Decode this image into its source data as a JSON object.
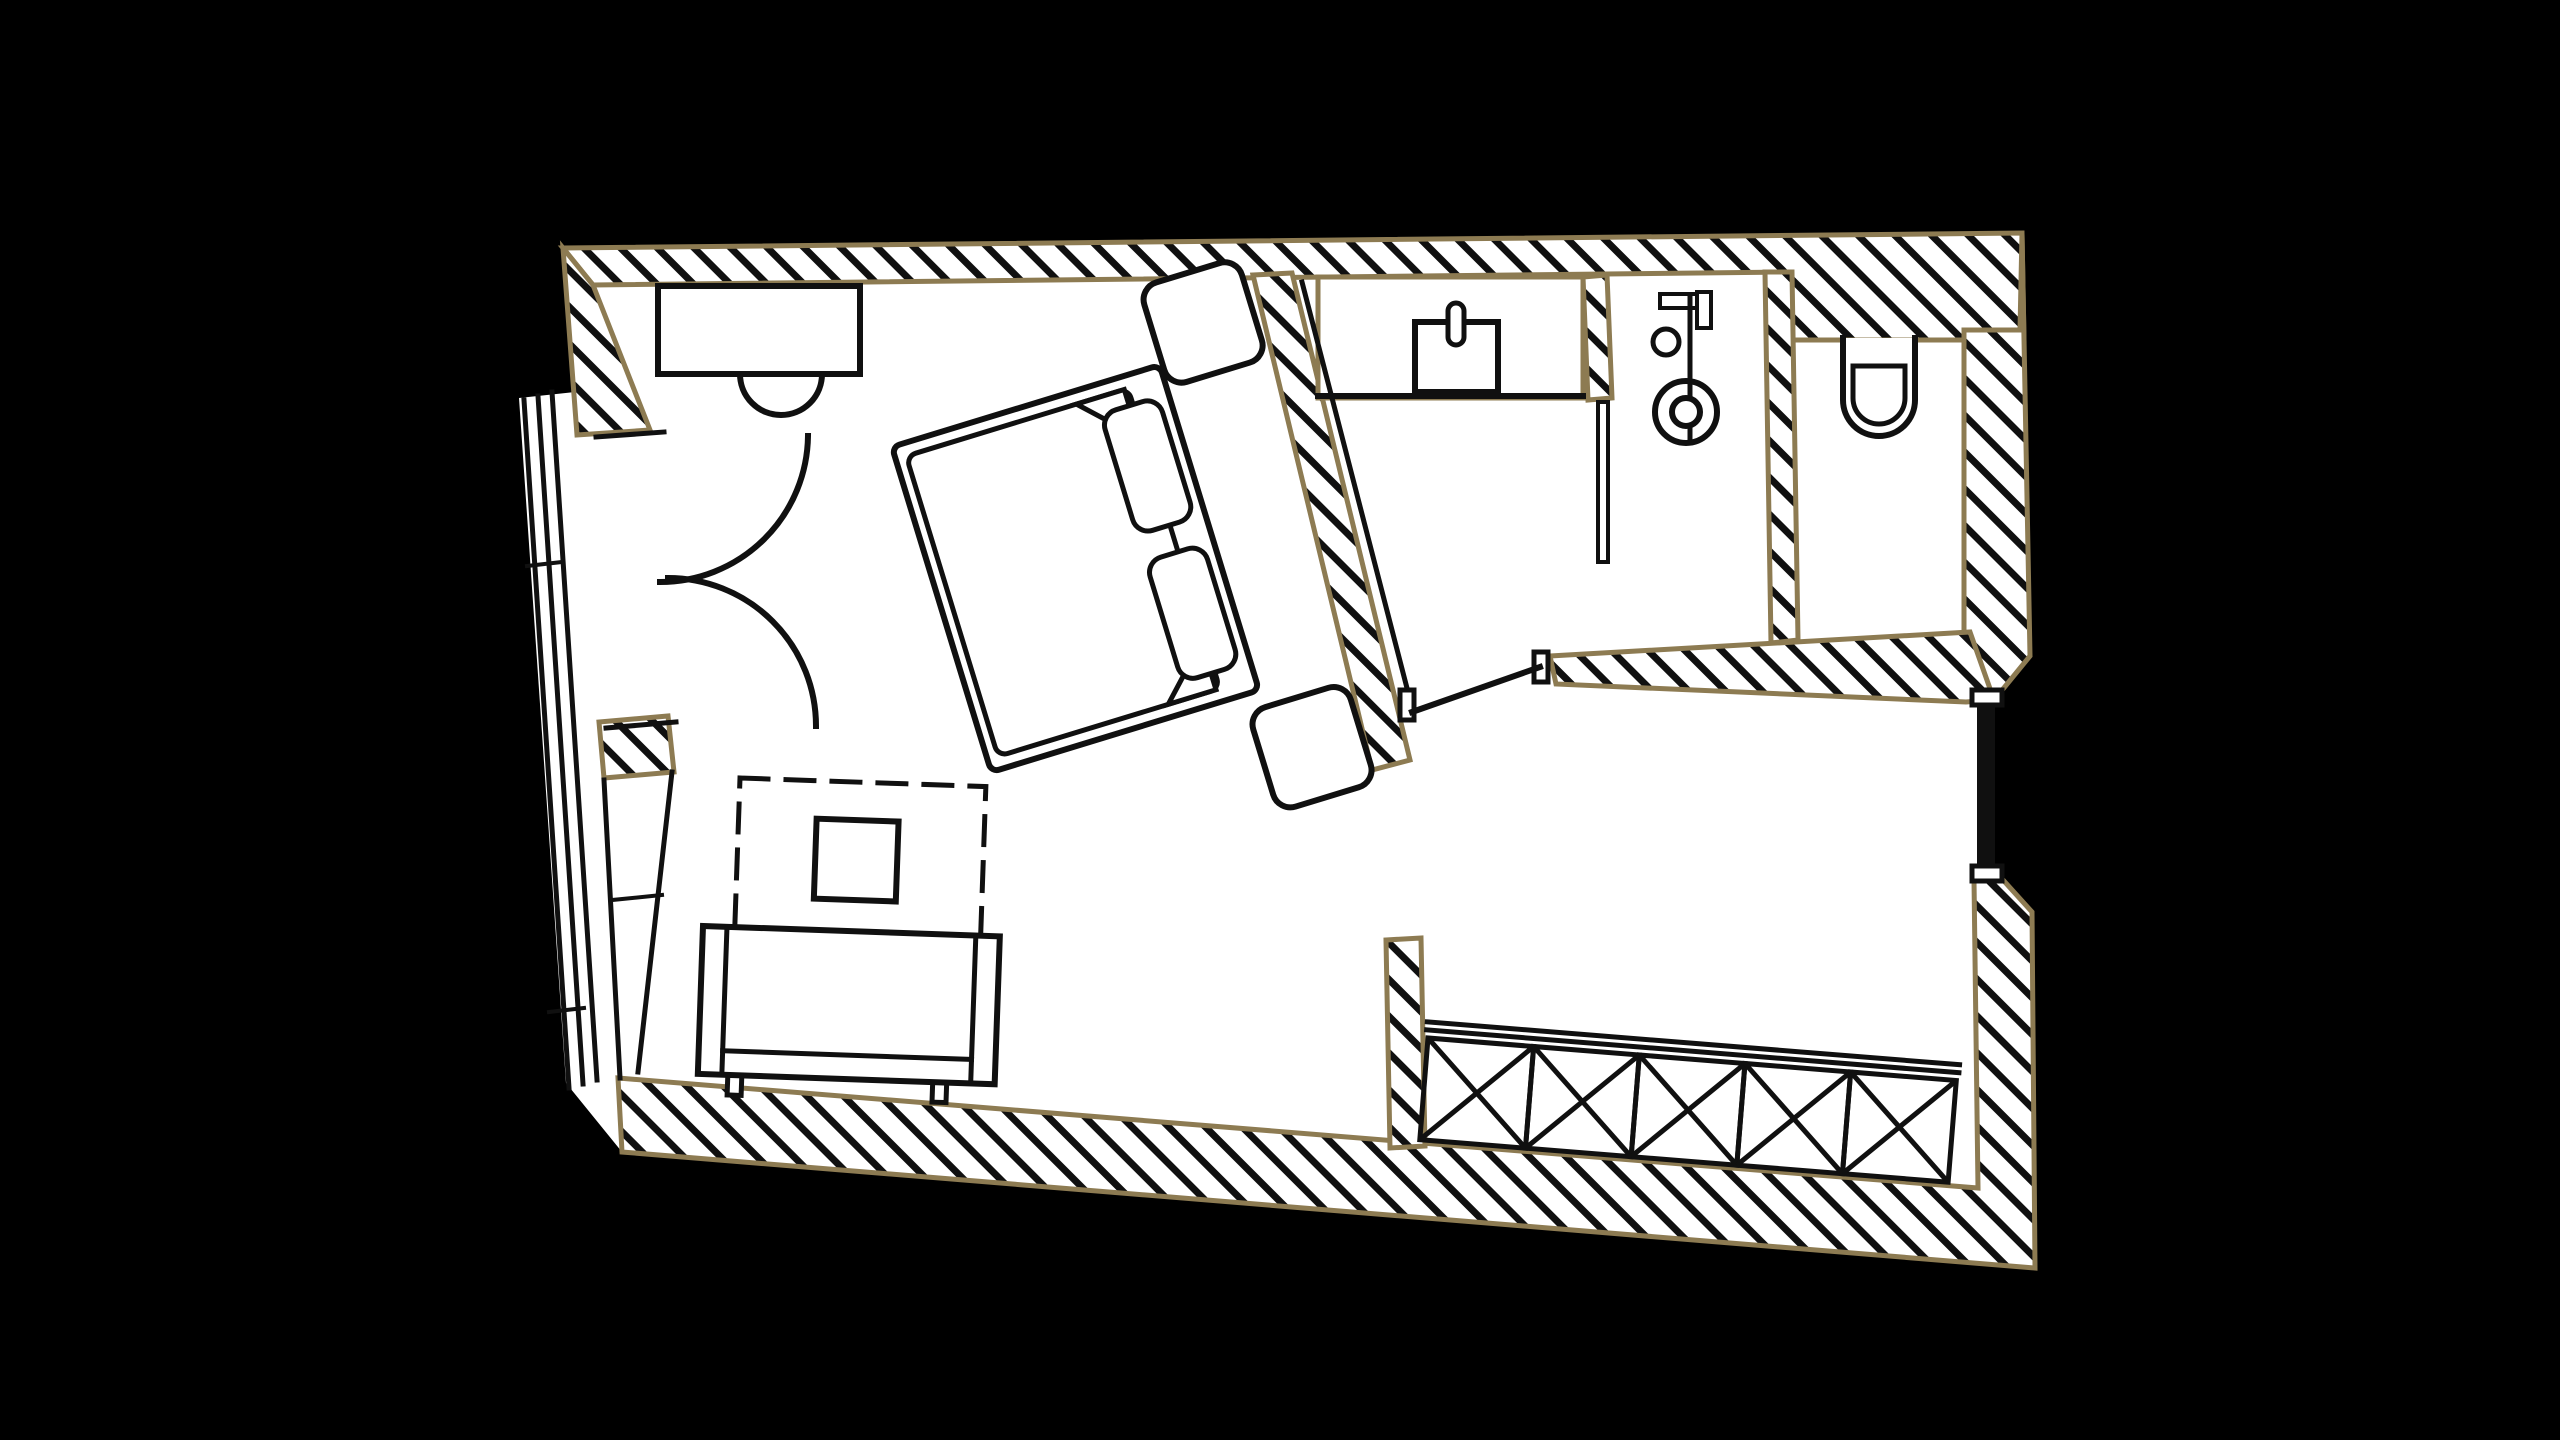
{
  "canvas": {
    "width": 2560,
    "height": 1440,
    "background": "#000000"
  },
  "palette": {
    "background": "#000000",
    "floor": "#ffffff",
    "ink": "#101010",
    "wall_outline": "#8d7b52",
    "hatch_spacing": 26,
    "hatch_line_width": 7,
    "hatch_angle": -45
  },
  "shapes": [
    {
      "name": "floor-area",
      "kind": "polygon",
      "points": "563,248 2022,233 2030,656 1994,700 1994,870 2032,912 2035,1268 622,1152 566,1083 519,398 575,392",
      "fill": "white",
      "stroke": "none"
    },
    {
      "name": "wall-top",
      "kind": "polygon",
      "points": "563,248 2022,233 2024,340 1787,340 1785,272 593,285",
      "fill": "hatch",
      "stroke": "tan",
      "sw": 5
    },
    {
      "name": "wall-right-upper",
      "kind": "polygon",
      "points": "2022,233 2030,656 1994,700 1964,700 1964,330 2020,330",
      "fill": "hatch",
      "stroke": "tan",
      "sw": 5
    },
    {
      "name": "wall-bottom-right",
      "kind": "polygon",
      "points": "618,1078 1978,1188 1974,880 1994,870 2032,912 2035,1268 622,1152",
      "fill": "hatch",
      "stroke": "tan",
      "sw": 5
    },
    {
      "name": "wall-left-upper",
      "kind": "polygon",
      "points": "563,248 577,435 650,430 593,285",
      "fill": "hatch",
      "stroke": "tan",
      "sw": 5
    },
    {
      "name": "wall-left-stub",
      "kind": "polygon",
      "points": "599,722 604,778 674,772 668,716",
      "fill": "hatch",
      "stroke": "tan",
      "sw": 5
    },
    {
      "name": "wall-bed-bathroom",
      "kind": "polygon",
      "points": "1253,275 1292,273 1410,760 1372,770",
      "fill": "hatch",
      "stroke": "tan",
      "sw": 5
    },
    {
      "name": "wall-shower-wc-divider",
      "kind": "polygon",
      "points": "1765,272 1792,272 1798,640 1771,643",
      "fill": "hatch",
      "stroke": "tan",
      "sw": 5
    },
    {
      "name": "wall-bathroom-low",
      "kind": "polygon",
      "points": "1550,656 1970,632 1994,700 1966,702 1556,684",
      "fill": "hatch",
      "stroke": "tan",
      "sw": 5
    },
    {
      "name": "wall-vanity-stub",
      "kind": "polygon",
      "points": "1583,277 1607,275 1612,398 1588,400",
      "fill": "hatch",
      "stroke": "tan",
      "sw": 5
    },
    {
      "name": "wall-wardrobe-stub",
      "kind": "polygon",
      "points": "1386,940 1421,938 1425,1146 1390,1148",
      "fill": "hatch",
      "stroke": "tan",
      "sw": 5
    },
    {
      "name": "balcony-railing",
      "kind": "group",
      "children": [
        {
          "name": "railing-line-outer",
          "kind": "line",
          "x1": 524,
          "y1": 400,
          "x2": 569,
          "y2": 1088,
          "sw": 5
        },
        {
          "name": "railing-line-middle",
          "kind": "line",
          "x1": 538,
          "y1": 396,
          "x2": 583,
          "y2": 1084,
          "sw": 5
        },
        {
          "name": "railing-line-inner",
          "kind": "line",
          "x1": 552,
          "y1": 392,
          "x2": 597,
          "y2": 1080,
          "sw": 5
        },
        {
          "name": "railing-tick-upper",
          "kind": "line",
          "x1": 527,
          "y1": 566,
          "x2": 562,
          "y2": 562,
          "sw": 4
        },
        {
          "name": "railing-tick-lower",
          "kind": "line",
          "x1": 549,
          "y1": 1012,
          "x2": 584,
          "y2": 1008,
          "sw": 4
        }
      ]
    },
    {
      "name": "left-window",
      "kind": "group",
      "children": [
        {
          "name": "window-outer-line",
          "kind": "line",
          "x1": 604,
          "y1": 780,
          "x2": 620,
          "y2": 1078,
          "sw": 5
        },
        {
          "name": "window-inner-line",
          "kind": "line",
          "x1": 672,
          "y1": 772,
          "x2": 638,
          "y2": 1072,
          "sw": 5
        },
        {
          "name": "window-crossbar",
          "kind": "line",
          "x1": 612,
          "y1": 900,
          "x2": 662,
          "y2": 895,
          "sw": 4
        }
      ]
    },
    {
      "name": "entry-double-door",
      "kind": "group",
      "children": [
        {
          "name": "door-jamb-top",
          "kind": "line",
          "x1": 596,
          "y1": 437,
          "x2": 664,
          "y2": 432,
          "sw": 5
        },
        {
          "name": "door-jamb-bottom",
          "kind": "line",
          "x1": 606,
          "y1": 728,
          "x2": 676,
          "y2": 722,
          "sw": 5
        },
        {
          "name": "door-leaf-upper-arc",
          "kind": "path",
          "d": "M 808 436 A 148 148 0 0 1 660 582",
          "sw": 6
        },
        {
          "name": "door-leaf-lower-arc",
          "kind": "path",
          "d": "M 668 578 A 148 148 0 0 1 816 726",
          "sw": 6
        }
      ]
    },
    {
      "name": "desk",
      "kind": "rect",
      "x": 658,
      "y": 286,
      "w": 202,
      "h": 88,
      "sw": 6,
      "fill": "white"
    },
    {
      "name": "desk-chair",
      "kind": "path",
      "d": "M 740 374 A 41 41 0 0 0 822 374",
      "sw": 6,
      "fill": "none"
    },
    {
      "name": "bed",
      "kind": "group",
      "transform": "translate(1195,532) rotate(73)",
      "children": [
        {
          "name": "nightstand-upper",
          "kind": "rect",
          "x": -250,
          "y": -120,
          "w": 104,
          "h": 102,
          "rx": 18,
          "sw": 6,
          "fill": "white"
        },
        {
          "name": "nightstand-lower",
          "kind": "rect",
          "x": 188,
          "y": -100,
          "w": 104,
          "h": 102,
          "rx": 18,
          "sw": 6,
          "fill": "white"
        },
        {
          "name": "bed-frame",
          "kind": "rect",
          "x": -170,
          "y": -15,
          "w": 340,
          "h": 280,
          "rx": 8,
          "sw": 6,
          "fill": "white"
        },
        {
          "name": "mattress",
          "kind": "rect",
          "x": -157,
          "y": 22,
          "w": 314,
          "h": 232,
          "rx": 10,
          "sw": 5,
          "fill": "none"
        },
        {
          "name": "blanket-fold-left",
          "kind": "path",
          "d": "M -157 26 L -107 26 L -157 76 Z",
          "sw": 5,
          "fill": "white"
        },
        {
          "name": "blanket-fold-right",
          "kind": "path",
          "d": "M 157 26 L 107 26 L 157 76 Z",
          "sw": 5,
          "fill": "white"
        },
        {
          "name": "pillow-left",
          "kind": "rect",
          "x": -140,
          "y": -4,
          "w": 126,
          "h": 60,
          "rx": 16,
          "sw": 5,
          "fill": "white"
        },
        {
          "name": "pillow-right",
          "kind": "rect",
          "x": 14,
          "y": -4,
          "w": 126,
          "h": 60,
          "rx": 16,
          "sw": 5,
          "fill": "white"
        }
      ]
    },
    {
      "name": "vanity-counter",
      "kind": "rect",
      "x": 1318,
      "y": 277,
      "w": 265,
      "h": 121,
      "sw": 5,
      "stroke": "tan",
      "fill": "white"
    },
    {
      "name": "vanity-front-edge",
      "kind": "line",
      "x1": 1318,
      "y1": 396,
      "x2": 1583,
      "y2": 396,
      "sw": 6
    },
    {
      "name": "sink",
      "kind": "rect",
      "x": 1415,
      "y": 322,
      "w": 83,
      "h": 70,
      "sw": 6,
      "fill": "white"
    },
    {
      "name": "faucet",
      "kind": "rect",
      "x": 1448,
      "y": 303,
      "w": 16,
      "h": 42,
      "rx": 8,
      "sw": 5,
      "fill": "white"
    },
    {
      "name": "shower-glass-panel",
      "kind": "rect",
      "x": 1598,
      "y": 402,
      "w": 10,
      "h": 160,
      "sw": 4,
      "fill": "white"
    },
    {
      "name": "shower-arm",
      "kind": "rect",
      "x": 1660,
      "y": 294,
      "w": 38,
      "h": 14,
      "sw": 4,
      "fill": "white"
    },
    {
      "name": "shower-head",
      "kind": "rect",
      "x": 1697,
      "y": 292,
      "w": 14,
      "h": 36,
      "sw": 4,
      "fill": "white"
    },
    {
      "name": "shower-knob",
      "kind": "circle",
      "cx": 1666,
      "cy": 342,
      "r": 13,
      "sw": 5,
      "fill": "white"
    },
    {
      "name": "shower-riser",
      "kind": "line",
      "x1": 1690,
      "y1": 296,
      "x2": 1690,
      "y2": 440,
      "sw": 5
    },
    {
      "name": "shower-drain-ring",
      "kind": "circle",
      "cx": 1686,
      "cy": 412,
      "r": 31,
      "sw": 6,
      "fill": "none"
    },
    {
      "name": "shower-drain-center",
      "kind": "circle",
      "cx": 1686,
      "cy": 412,
      "r": 14,
      "sw": 6,
      "fill": "white"
    },
    {
      "name": "bath-partition-line",
      "kind": "line",
      "x1": 1302,
      "y1": 282,
      "x2": 1408,
      "y2": 692,
      "sw": 5
    },
    {
      "name": "bathroom-door",
      "kind": "group",
      "children": [
        {
          "name": "door-jamb-left",
          "kind": "rect",
          "x": 1400,
          "y": 690,
          "w": 14,
          "h": 30,
          "sw": 5,
          "fill": "white"
        },
        {
          "name": "door-jamb-right",
          "kind": "rect",
          "x": 1534,
          "y": 652,
          "w": 14,
          "h": 30,
          "sw": 5,
          "fill": "white"
        },
        {
          "name": "door-leaf",
          "kind": "line",
          "x1": 1412,
          "y1": 712,
          "x2": 1540,
          "y2": 667,
          "sw": 6
        }
      ]
    },
    {
      "name": "toilet",
      "kind": "group",
      "children": [
        {
          "name": "toilet-bowl-outline",
          "kind": "path",
          "d": "M 1843 338 L 1843 400 A 36 36 0 0 0 1915 400 L 1915 338",
          "sw": 6,
          "fill": "white"
        },
        {
          "name": "toilet-seat",
          "kind": "path",
          "d": "M 1853 366 L 1905 366 L 1905 398 A 26 26 0 0 1 1853 398 Z",
          "sw": 5,
          "fill": "white"
        }
      ]
    },
    {
      "name": "right-window",
      "kind": "group",
      "children": [
        {
          "name": "right-window-bar",
          "kind": "rect",
          "x": 1977,
          "y": 705,
          "w": 18,
          "h": 162,
          "fill": "ink",
          "stroke": "none"
        },
        {
          "name": "right-window-cap-top",
          "kind": "rect",
          "x": 1972,
          "y": 690,
          "w": 30,
          "h": 15,
          "sw": 5,
          "fill": "white"
        },
        {
          "name": "right-window-cap-bottom",
          "kind": "rect",
          "x": 1972,
          "y": 866,
          "w": 30,
          "h": 15,
          "sw": 5,
          "fill": "white"
        }
      ]
    },
    {
      "name": "table-area",
      "kind": "group",
      "transform": "translate(740,778) rotate(2)",
      "children": [
        {
          "name": "ceiling-projection-dashed",
          "kind": "rect",
          "x": 0,
          "y": 0,
          "w": 246,
          "h": 172,
          "sw": 5,
          "dash": [
            28,
            18
          ],
          "fill": "none"
        },
        {
          "name": "side-table",
          "kind": "rect",
          "x": 78,
          "y": 38,
          "w": 82,
          "h": 80,
          "sw": 6,
          "fill": "white"
        }
      ]
    },
    {
      "name": "bench",
      "kind": "group",
      "transform": "translate(703,926) rotate(2)",
      "children": [
        {
          "name": "bench-leg-left",
          "kind": "rect",
          "x": 30,
          "y": 146,
          "w": 14,
          "h": 22,
          "sw": 5,
          "fill": "white"
        },
        {
          "name": "bench-leg-right",
          "kind": "rect",
          "x": 235,
          "y": 146,
          "w": 14,
          "h": 22,
          "sw": 5,
          "fill": "white"
        },
        {
          "name": "bench-frame",
          "kind": "rect",
          "x": 0,
          "y": 0,
          "w": 297,
          "h": 148,
          "sw": 6,
          "fill": "white"
        },
        {
          "name": "bench-armrest-left",
          "kind": "line",
          "x1": 24,
          "y1": 3,
          "x2": 24,
          "y2": 145,
          "sw": 5
        },
        {
          "name": "bench-armrest-right",
          "kind": "line",
          "x1": 273,
          "y1": 3,
          "x2": 273,
          "y2": 145,
          "sw": 5
        },
        {
          "name": "bench-seat-edge",
          "kind": "line",
          "x1": 24,
          "y1": 124,
          "x2": 273,
          "y2": 124,
          "sw": 5
        }
      ]
    },
    {
      "name": "wardrobe",
      "kind": "group",
      "transform": "translate(1428,1038) rotate(4.6)",
      "children": [
        {
          "name": "wardrobe-rail-outer",
          "kind": "line",
          "x1": -2,
          "y1": -16,
          "x2": 532,
          "y2": -16,
          "sw": 5
        },
        {
          "name": "wardrobe-rail-inner",
          "kind": "line",
          "x1": -2,
          "y1": -8,
          "x2": 532,
          "y2": -8,
          "sw": 5
        },
        {
          "name": "wardrobe-cell-1",
          "kind": "xrect",
          "x": 0,
          "y": 0,
          "w": 106,
          "h": 102,
          "sw": 5
        },
        {
          "name": "wardrobe-cell-2",
          "kind": "xrect",
          "x": 106,
          "y": 0,
          "w": 106,
          "h": 102,
          "sw": 5
        },
        {
          "name": "wardrobe-cell-3",
          "kind": "xrect",
          "x": 212,
          "y": 0,
          "w": 106,
          "h": 102,
          "sw": 5
        },
        {
          "name": "wardrobe-cell-4",
          "kind": "xrect",
          "x": 318,
          "y": 0,
          "w": 106,
          "h": 102,
          "sw": 5
        },
        {
          "name": "wardrobe-cell-5",
          "kind": "xrect",
          "x": 424,
          "y": 0,
          "w": 106,
          "h": 102,
          "sw": 5
        }
      ]
    }
  ]
}
